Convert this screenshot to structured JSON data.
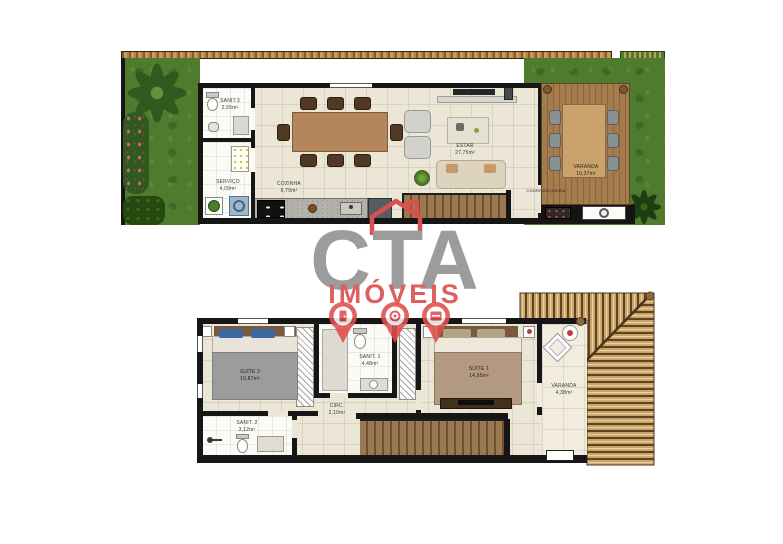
{
  "watermark": {
    "brand": "CTA",
    "subtitle": "IMÓVEIS",
    "brand_color": "#9c9c9c",
    "accent_color": "#dd5f5f",
    "pin_count": 3
  },
  "palette": {
    "grass_green": "#4e7b2e",
    "wall_black": "#161616",
    "deck_wood": "#a57c4e",
    "roof_tan": "#caa466",
    "floor_beige": "#ece6d6",
    "pin_red": "#e04e4e"
  },
  "floors": {
    "ground": {
      "rooms": [
        {
          "name": "SANIT.3",
          "area": "2,55m²"
        },
        {
          "name": "SERVIÇO",
          "area": "4,09m²"
        },
        {
          "name": "COZINHA",
          "area": "6,79m²"
        },
        {
          "name": "ESTAR",
          "area": "27,75m²"
        },
        {
          "name": "VARANDA",
          "area": "10,37m²"
        },
        {
          "name": "CHURRASQUEIRA",
          "area": ""
        }
      ]
    },
    "upper": {
      "rooms": [
        {
          "name": "SUÍTE 2",
          "area": "10,87m²"
        },
        {
          "name": "SANIT. 1",
          "area": "4,48m²"
        },
        {
          "name": "SUÍTE 1",
          "area": "14,95m²"
        },
        {
          "name": "VARANDA",
          "area": "4,38m²"
        },
        {
          "name": "CIRC.",
          "area": "2,10m²"
        },
        {
          "name": "SANIT. 2",
          "area": "3,12m²"
        }
      ]
    }
  }
}
